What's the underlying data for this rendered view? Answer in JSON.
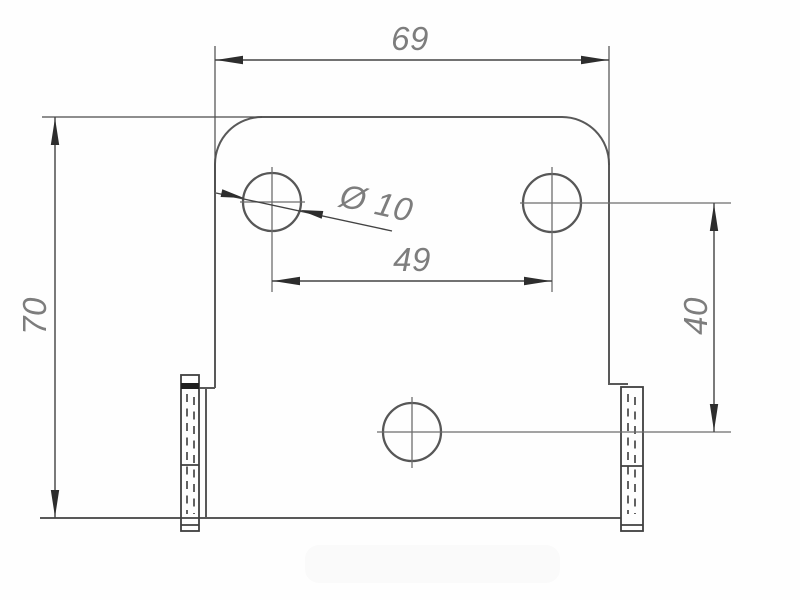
{
  "drawing": {
    "type": "technical-drawing",
    "part": "bracket-plate-front-view",
    "dimensions": {
      "overall_width": "69",
      "overall_height": "70",
      "hole_spacing_horizontal": "49",
      "hole_spacing_vertical": "40",
      "hole_diameter": "Ø 10"
    },
    "features": {
      "holes_count": 3,
      "flanges_count": 2
    },
    "colors": {
      "background": "#fefefe",
      "outline": "#595959",
      "dimension_lines": "#434343",
      "dimension_text": "#7d7d7d",
      "centerlines": "#6d6d6d"
    }
  }
}
